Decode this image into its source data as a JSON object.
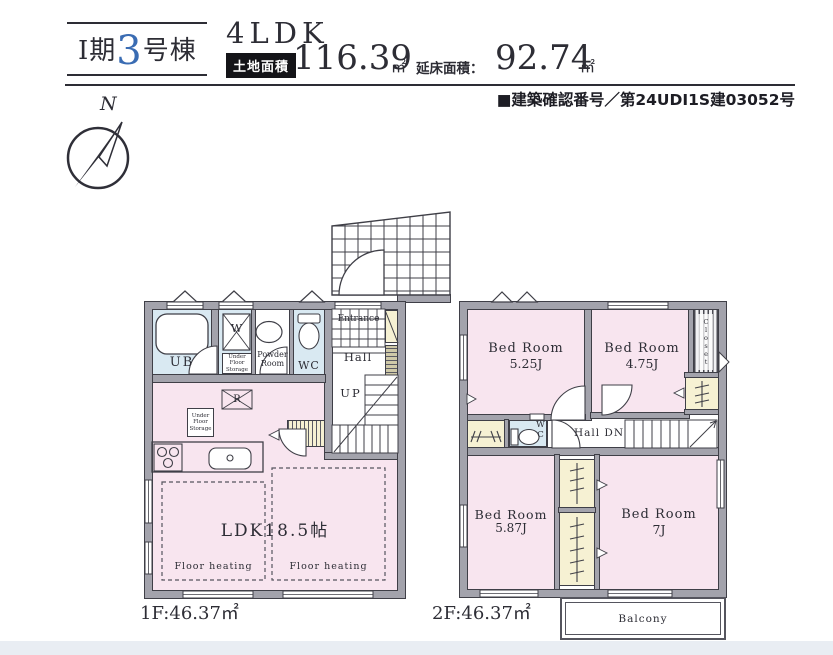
{
  "header": {
    "phase": "I期",
    "unit_no": "3",
    "unit_suffix": "号棟",
    "plan_type": "4LDK",
    "land_label": "土地面積",
    "land_value": "116.39",
    "land_unit": "㎡",
    "floor_label": "延床面積：",
    "floor_value": "92.74",
    "floor_unit": "㎡",
    "confirmation": "■建築確認番号／第24UDI1S建03052号"
  },
  "compass": {
    "north": "N"
  },
  "floor1": {
    "area_label": "1F:46.37㎡",
    "rooms": {
      "ub": "UB",
      "washer": "W",
      "under_floor_storage": "Under Floor Storage",
      "powder_room": "Powder Room",
      "wc": "WC",
      "entrance": "Entrance",
      "hall": "Hall",
      "up": "UP",
      "refrigerator": "R",
      "ldk": "LDK18.5帖",
      "floor_heating": "Floor heating"
    }
  },
  "floor2": {
    "area_label": "2F:46.37㎡",
    "bedrooms": [
      {
        "name": "Bed Room",
        "size": "5.25J"
      },
      {
        "name": "Bed Room",
        "size": "4.75J"
      },
      {
        "name": "Bed Room",
        "size": "5.87J"
      },
      {
        "name": "Bed Room",
        "size": "7J"
      }
    ],
    "closet": "Closet",
    "wc": "WC",
    "hall": "Hall DN",
    "balcony": "Balcony"
  },
  "colors": {
    "accent_blue": "#3a6cb3",
    "room_pink": "#f8e5ef",
    "room_blue": "#d9e9f2",
    "closet_cream": "#f6f1d3",
    "wall_gray": "#a3a3ac"
  }
}
